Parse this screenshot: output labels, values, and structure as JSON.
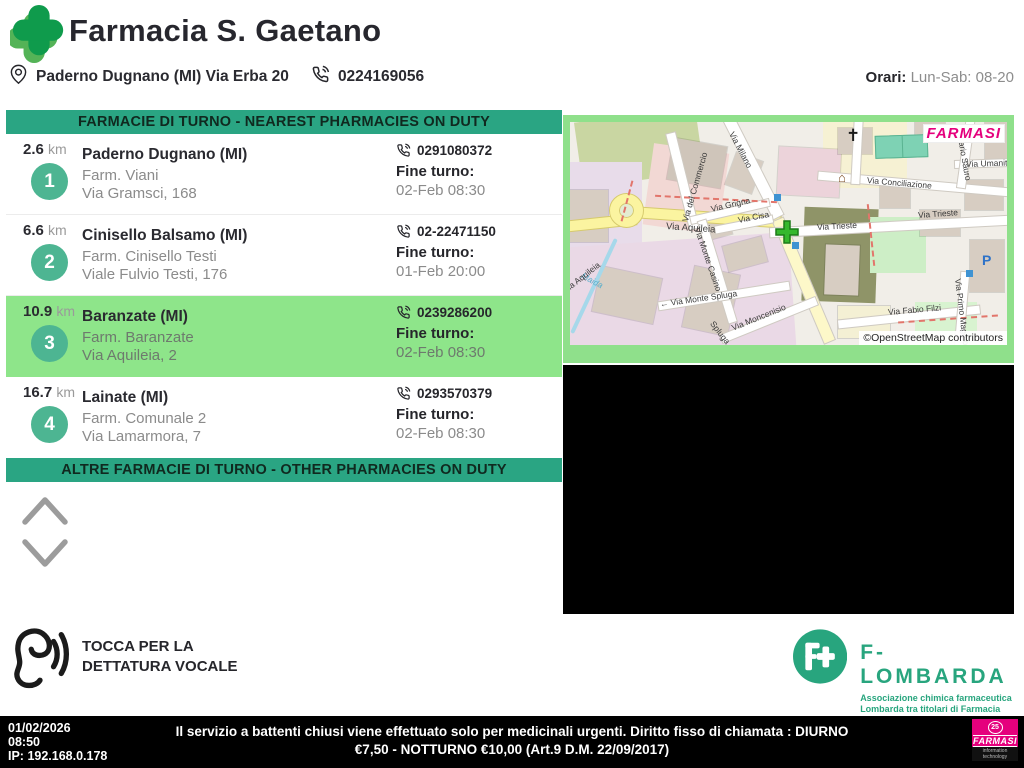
{
  "header": {
    "title": "Farmacia S. Gaetano",
    "address": "Paderno Dugnano (MI) Via Erba 20",
    "phone": "0224169056",
    "hours_label": "Orari:",
    "hours_value": "Lun-Sab: 08-20"
  },
  "nearest": {
    "title": "FARMACIE DI TURNO - NEAREST PHARMACIES ON DUTY",
    "items": [
      {
        "rank": "1",
        "distance": "2.6",
        "unit": "km",
        "city": "Paderno Dugnano (MI)",
        "name": "Farm. Viani",
        "street": "Via Gramsci, 168",
        "phone": "0291080372",
        "fine_label": "Fine turno:",
        "fine_value": "02-Feb 08:30"
      },
      {
        "rank": "2",
        "distance": "6.6",
        "unit": "km",
        "city": "Cinisello Balsamo (MI)",
        "name": "Farm. Cinisello Testi",
        "street": "Viale Fulvio Testi, 176",
        "phone": "02-22471150",
        "fine_label": "Fine turno:",
        "fine_value": "01-Feb 20:00"
      },
      {
        "rank": "3",
        "distance": "10.9",
        "unit": "km",
        "city": "Baranzate (MI)",
        "name": "Farm. Baranzate",
        "street": "Via Aquileia, 2",
        "phone": "0239286200",
        "fine_label": "Fine turno:",
        "fine_value": "02-Feb 08:30"
      },
      {
        "rank": "4",
        "distance": "16.7",
        "unit": "km",
        "city": "Lainate (MI)",
        "name": "Farm. Comunale 2",
        "street": "Via Lamarmora, 7",
        "phone": "0293570379",
        "fine_label": "Fine turno:",
        "fine_value": "02-Feb 08:30"
      }
    ]
  },
  "other": {
    "title": "ALTRE FARMACIE DI TURNO - OTHER PHARMACIES ON DUTY"
  },
  "voice": {
    "line1": "TOCCA PER LA",
    "line2": "DETTATURA VOCALE"
  },
  "map": {
    "brand": "FARMASI",
    "attribution": "©OpenStreetMap contributors",
    "parking": "P",
    "church_glyph": "✝",
    "shrine_glyph": "⌂",
    "labels": [
      "Via del Commercio",
      "Via Milano",
      "Via Grigna",
      "Via Cisa",
      "Via Aquileia",
      "Via Trieste",
      "Via Conciliazione",
      "Via Umanità",
      "Nazario Sauro",
      "Via Monte Casino",
      "← Via Monte Spluga",
      "Spluga",
      "Via Moncenisio",
      "Via Fabio Filzi",
      "Via Trieste",
      "Maida",
      "Via Primo Maggio",
      "Via Aquileia"
    ]
  },
  "flombarda": {
    "name": "F-LOMBARDA",
    "sub1": "Associazione chimica farmaceutica",
    "sub2": "Lombarda tra titolari di Farmacia"
  },
  "footer": {
    "date": "01/02/2026",
    "time": "08:50",
    "ip": "IP: 192.168.0.178",
    "notice": "Il servizio a battenti chiusi viene effettuato solo per medicinali urgenti. Diritto fisso di chiamata : DIURNO €7,50 - NOTTURNO €10,00 (Art.9 D.M. 22/09/2017)",
    "logo": {
      "badge": "25",
      "name": "FARMASI",
      "sub": "information technology"
    }
  },
  "colors": {
    "accent_green": "#2aa583",
    "highlight_green": "#8ee58a",
    "badge_green": "#4db592",
    "map_frame_green": "#8fe08b",
    "magenta": "#e5007d",
    "logo_green": "#0f9b4c"
  }
}
